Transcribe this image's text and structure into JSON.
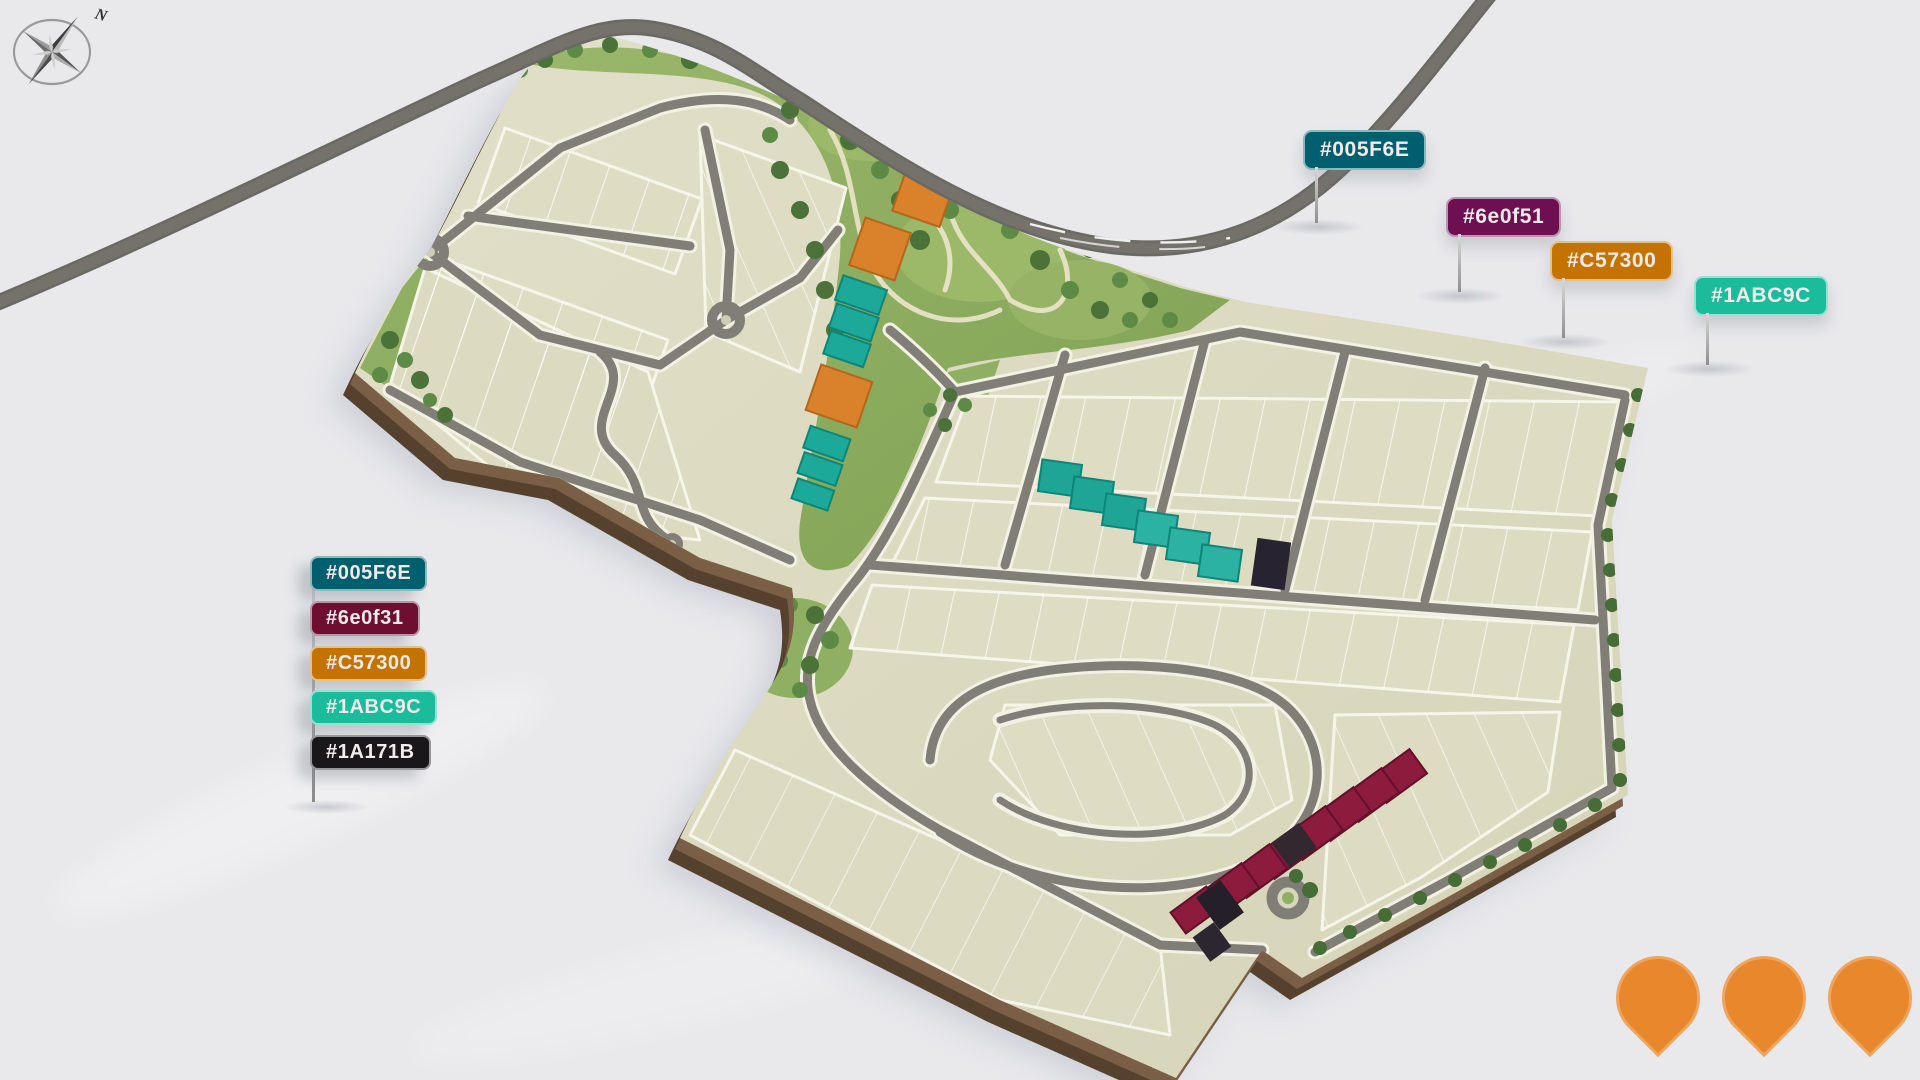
{
  "scene": {
    "background": "#E9E9EC",
    "description": "3D aerial masterplan render of a residential land estate with colour-key flags"
  },
  "legend": {
    "items": [
      {
        "label": "#005F6E",
        "color": "#005F6E"
      },
      {
        "label": "#6e0f31",
        "color": "#6e0f31"
      },
      {
        "label": "#C57300",
        "color": "#C57300"
      },
      {
        "label": "#1ABC9C",
        "color": "#1ABC9C"
      },
      {
        "label": "#1A171B",
        "color": "#1A171B"
      }
    ]
  },
  "flags": [
    {
      "label": "#005F6E",
      "color": "#005F6E",
      "x": 1303,
      "y": 130,
      "post_height": 56
    },
    {
      "label": "#6e0f51",
      "color": "#6e0f51",
      "x": 1446,
      "y": 197,
      "post_height": 58
    },
    {
      "label": "#C57300",
      "color": "#C57300",
      "x": 1550,
      "y": 241,
      "post_height": 60
    },
    {
      "label": "#1ABC9C",
      "color": "#1ABC9C",
      "x": 1694,
      "y": 276,
      "post_height": 52
    }
  ],
  "compass": {
    "label": "N"
  },
  "pins": {
    "count": 3,
    "color": "#E8872B"
  },
  "map": {
    "building_colors": {
      "teal": "#1CA99A",
      "orange": "#D9822B",
      "maroon": "#8C1B3E",
      "black": "#26222A"
    },
    "land_color": "#DBD9BE",
    "park_color": "#8FAF63",
    "road_color": "#817E77",
    "highway_color": "#6B6963"
  }
}
